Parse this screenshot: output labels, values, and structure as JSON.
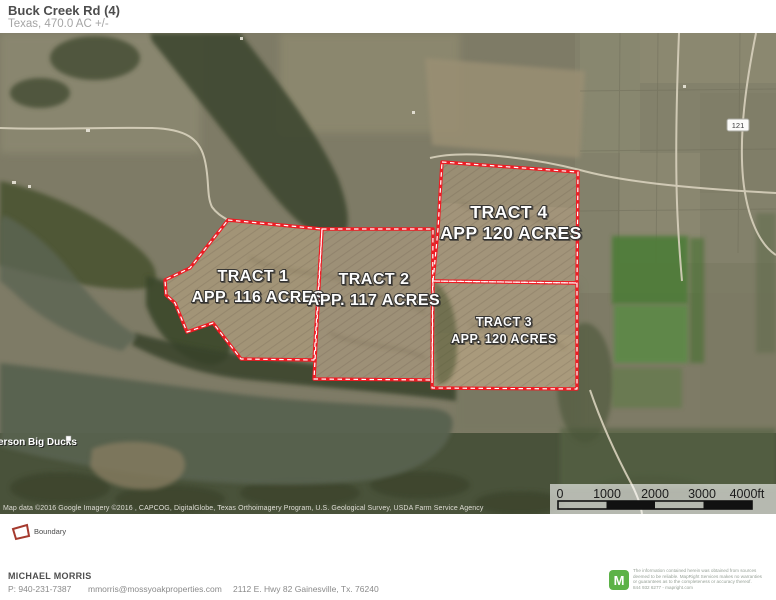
{
  "header": {
    "title": "Buck Creek Rd (4)",
    "subtitle": "Texas, 470.0  AC +/-"
  },
  "map": {
    "tracts": [
      {
        "name": "TRACT 1",
        "acres": "APP. 116 ACRES"
      },
      {
        "name": "TRACT 2",
        "acres": "APP. 117 ACRES"
      },
      {
        "name": "TRACT 3",
        "acres": "APP. 120 ACRES"
      },
      {
        "name": "TRACT 4",
        "acres": "APP 120 ACRES"
      }
    ],
    "road_label": "121",
    "place_label": "erson Big Ducks",
    "attribution": "Map data ©2016 Google  Imagery ©2016 , CAPCOG, DigitalGlobe, Texas Orthoimagery Program, U.S. Geological Survey, USDA Farm Service Agency",
    "scale": {
      "ticks": [
        "0",
        "1000",
        "2000",
        "3000",
        "4000ft"
      ]
    }
  },
  "legend": {
    "boundary_label": "Boundary",
    "boundary_color": "#a53a2e"
  },
  "footer": {
    "agent": "MICHAEL MORRIS",
    "phone": "P: 940-231-7387",
    "email": "mmorris@mossyoakproperties.com",
    "address": "2112 E. Hwy 82 Gainesville, Tx. 76240",
    "logo_letter": "M",
    "logo_color": "#5cb247",
    "disclaimer_lines": [
      "The information contained herein was obtained from sources",
      "deemed to be reliable. MapRight Services makes no warranties",
      "or guarantees as to the completeness or accuracy thereof.",
      "844 932 6277 - mapright.com"
    ]
  },
  "colors": {
    "boundary_red": "#ee1c24",
    "field_tan": "#a29477",
    "water": "#59624f"
  }
}
